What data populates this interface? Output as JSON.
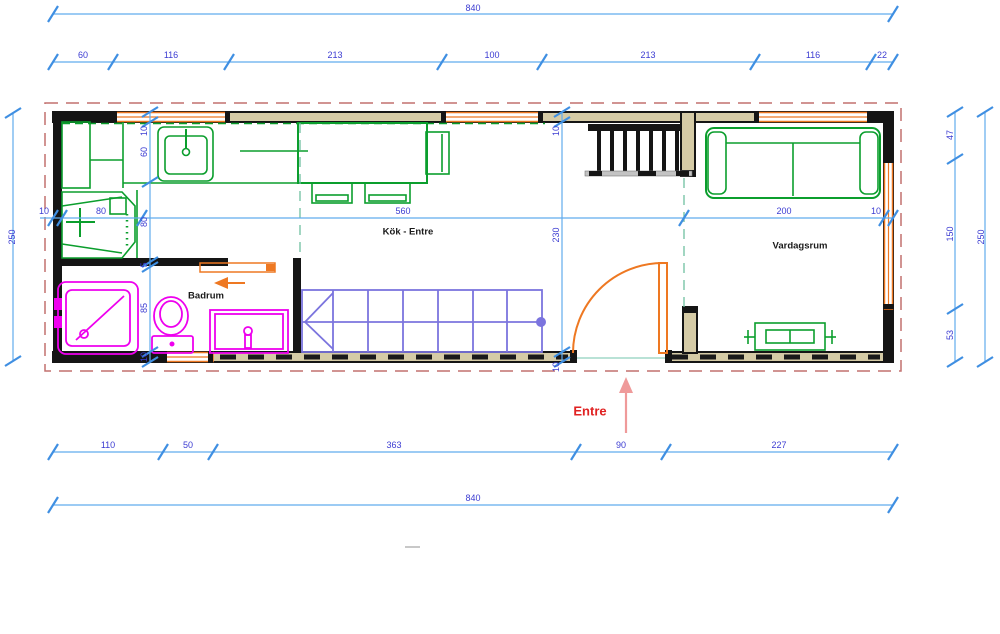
{
  "colors": {
    "dimension_line": "#62aced",
    "tick": "#3f8fe2",
    "dimension_text": "#3c3cd2",
    "wall_fill": "#d5cba6",
    "wall_stroke": "#151515",
    "window": "#ee7822",
    "door": "#ee7822",
    "furniture_green": "#0b9e2d",
    "bathroom_magenta": "#ee00ee",
    "wardrobe_purple": "#7b74de",
    "boundary_dash": "#c2716f",
    "reference_dash": "#6fbfa0",
    "entre_text": "#e02222",
    "entre_arrow": "#ef9a9a",
    "room_text": "#1a1a1a"
  },
  "rooms": [
    {
      "id": "kok-entre",
      "label": "Kök - Entre",
      "x": 408,
      "y": 232
    },
    {
      "id": "vardagsrum",
      "label": "Vardagsrum",
      "x": 800,
      "y": 246
    },
    {
      "id": "badrum",
      "label": "Badrum",
      "x": 206,
      "y": 296
    }
  ],
  "entrance": {
    "label": "Entre",
    "x": 590,
    "y": 411
  },
  "dimensions": {
    "overall_width": "840",
    "overall_height": "250",
    "chains": {
      "top_segments": [
        "60",
        "116",
        "213",
        "100",
        "213",
        "116",
        "22"
      ],
      "bottom_segments": [
        "110",
        "50",
        "363",
        "90",
        "227"
      ],
      "right_segments": [
        "47",
        "150",
        "53"
      ],
      "left_interior_segments": [
        "10",
        "60",
        "80",
        "5",
        "85",
        "10"
      ],
      "mid_horizontal_segments": [
        "10",
        "80",
        "560",
        "200",
        "10"
      ],
      "mid_vertical_segments": [
        "10",
        "230",
        "10"
      ]
    },
    "labels": [
      {
        "text": "840",
        "x": 473,
        "y": 8
      },
      {
        "text": "60",
        "x": 83,
        "y": 55
      },
      {
        "text": "116",
        "x": 171,
        "y": 55
      },
      {
        "text": "213",
        "x": 335,
        "y": 55
      },
      {
        "text": "100",
        "x": 492,
        "y": 55
      },
      {
        "text": "213",
        "x": 648,
        "y": 55
      },
      {
        "text": "116",
        "x": 813,
        "y": 55
      },
      {
        "text": "22",
        "x": 882,
        "y": 55
      },
      {
        "text": "250",
        "x": 12,
        "y": 237,
        "rot": 1
      },
      {
        "text": "47",
        "x": 950,
        "y": 135,
        "rot": 1
      },
      {
        "text": "150",
        "x": 950,
        "y": 234,
        "rot": 1
      },
      {
        "text": "53",
        "x": 950,
        "y": 335,
        "rot": 1
      },
      {
        "text": "250",
        "x": 981,
        "y": 237,
        "rot": 1
      },
      {
        "text": "110",
        "x": 108,
        "y": 445
      },
      {
        "text": "50",
        "x": 188,
        "y": 445
      },
      {
        "text": "363",
        "x": 394,
        "y": 445
      },
      {
        "text": "90",
        "x": 621,
        "y": 445
      },
      {
        "text": "227",
        "x": 779,
        "y": 445
      },
      {
        "text": "840",
        "x": 473,
        "y": 498
      },
      {
        "text": "10",
        "x": 44,
        "y": 211
      },
      {
        "text": "80",
        "x": 101,
        "y": 211
      },
      {
        "text": "560",
        "x": 403,
        "y": 211
      },
      {
        "text": "200",
        "x": 784,
        "y": 211
      },
      {
        "text": "10",
        "x": 876,
        "y": 211
      },
      {
        "text": "10",
        "x": 144,
        "y": 131,
        "rot": 1
      },
      {
        "text": "60",
        "x": 144,
        "y": 152,
        "rot": 1
      },
      {
        "text": "80",
        "x": 144,
        "y": 222,
        "rot": 1
      },
      {
        "text": "5",
        "x": 144,
        "y": 265,
        "rot": 1
      },
      {
        "text": "85",
        "x": 144,
        "y": 308,
        "rot": 1
      },
      {
        "text": "10",
        "x": 144,
        "y": 357,
        "rot": 1
      },
      {
        "text": "10",
        "x": 556,
        "y": 131,
        "rot": 1
      },
      {
        "text": "230",
        "x": 556,
        "y": 235,
        "rot": 1
      },
      {
        "text": "10",
        "x": 556,
        "y": 367,
        "rot": 1
      }
    ]
  }
}
